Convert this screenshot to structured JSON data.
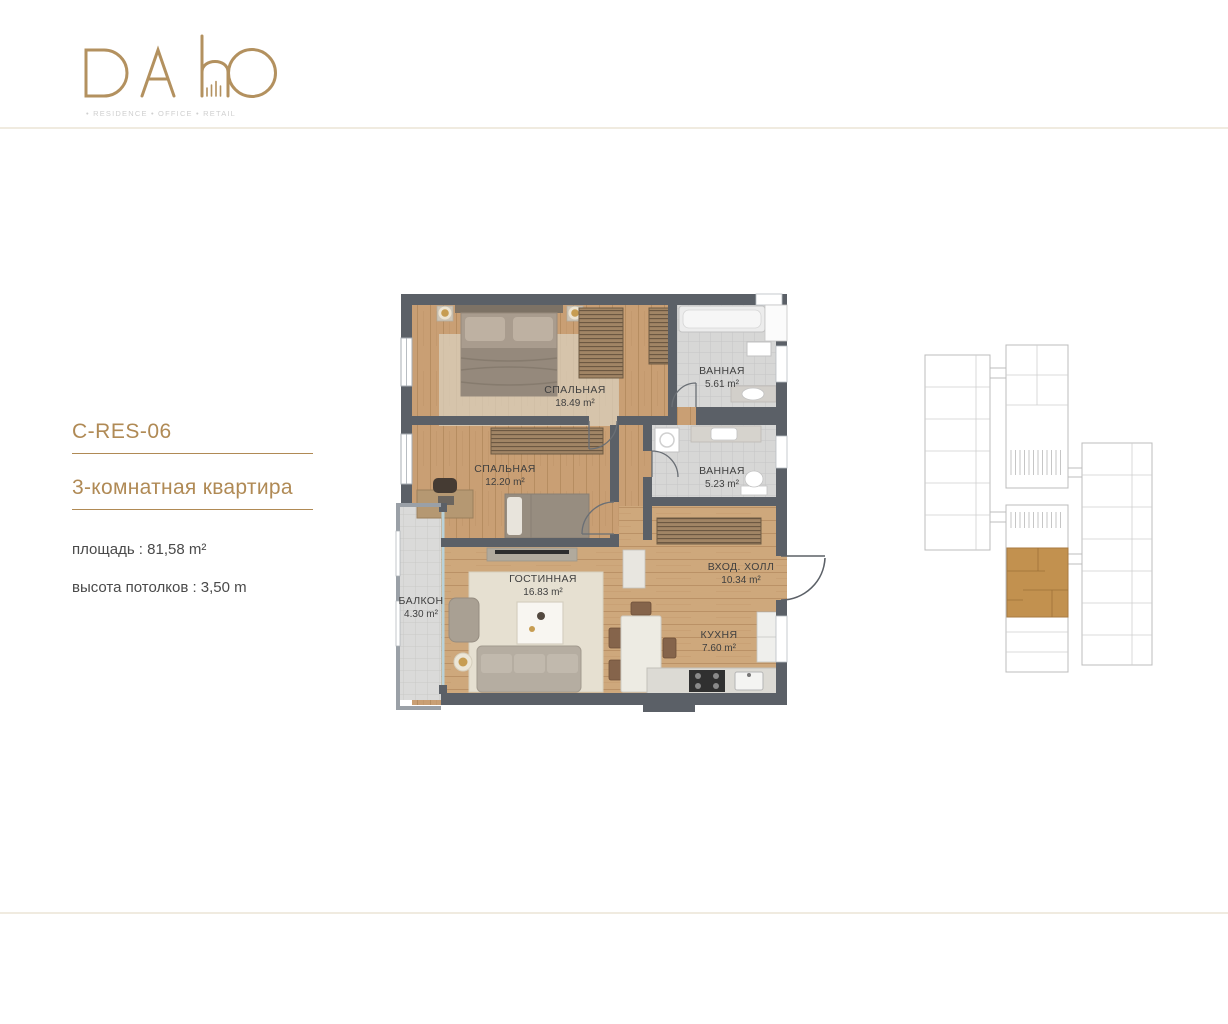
{
  "brand": {
    "name": "DAhO",
    "tagline": "• RESIDENCE • OFFICE • RETAIL"
  },
  "apartment": {
    "code": "C-RES-06",
    "title": "3-комнатная квартира",
    "area_label": "площадь : 81,58 m²",
    "ceiling_label": "высота потолков : 3,50 m"
  },
  "floorplan": {
    "rooms": [
      {
        "name": "СПАЛЬНАЯ",
        "area": "18.49 m²"
      },
      {
        "name": "ВАННАЯ",
        "area": "5.61 m²"
      },
      {
        "name": "СПАЛЬНАЯ",
        "area": "12.20 m²"
      },
      {
        "name": "ВАННАЯ",
        "area": "5.23 m²"
      },
      {
        "name": "ГОСТИННАЯ",
        "area": "16.83 m²"
      },
      {
        "name": "ВХОД. ХОЛЛ",
        "area": "10.34 m²"
      },
      {
        "name": "КУХНЯ",
        "area": "7.60 m²"
      },
      {
        "name": "БАЛКОН",
        "area": "4.30 m²"
      }
    ]
  },
  "keyplan": {
    "highlight_color": "#c2914f"
  },
  "colors": {
    "accent_gold": "#b08a55",
    "logo_gold": "#b3915f",
    "wall": "#5b6067",
    "wood": "#c9a176",
    "tile": "#d7d7d6",
    "text": "#4a4a4a",
    "divider": "#f0ebe0"
  }
}
